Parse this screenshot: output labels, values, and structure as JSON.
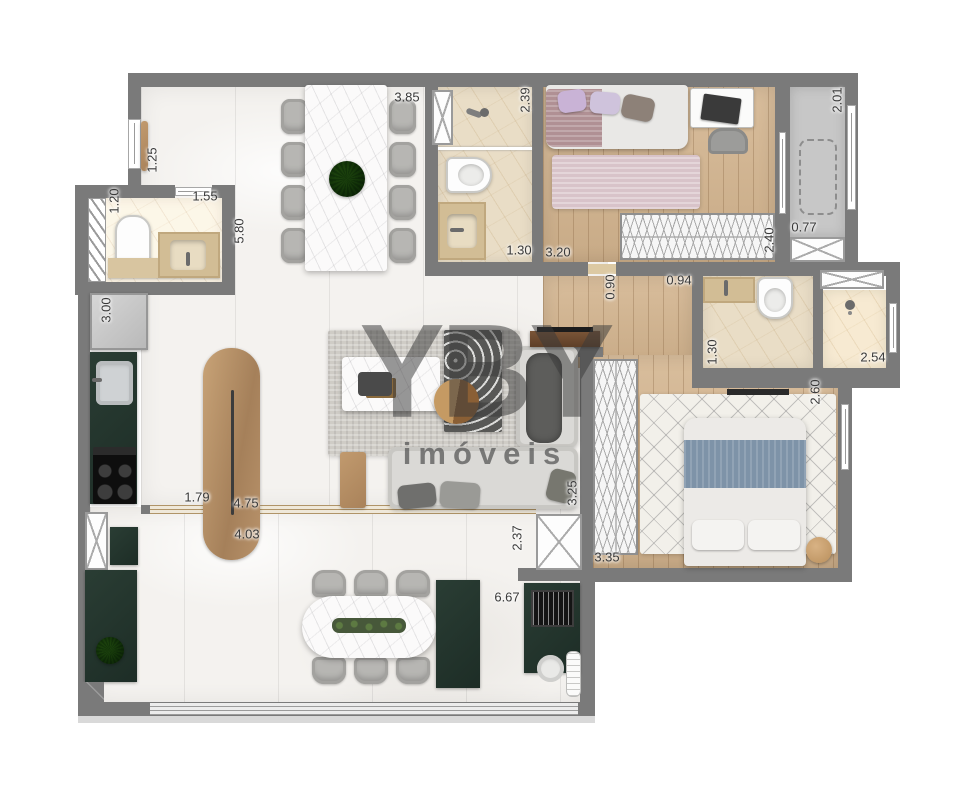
{
  "watermark": {
    "brand": "YBY",
    "subtitle": "imóveis"
  },
  "colors": {
    "wall": "#7a7a7a",
    "marble_floor": "#f4f2ef",
    "wood_floor": "#d3b48e",
    "bath_floor": "#e9ddc6",
    "counter_green": "#22332c",
    "gray_room": "#c7c7c7",
    "watermark_text": "#4a4a4a"
  },
  "dimensions": [
    {
      "label": "1.25",
      "x": 152,
      "y": 160,
      "rot": true
    },
    {
      "label": "1.20",
      "x": 114,
      "y": 201,
      "rot": true
    },
    {
      "label": "1.55",
      "x": 205,
      "y": 196,
      "rot": false
    },
    {
      "label": "5.80",
      "x": 239,
      "y": 231,
      "rot": true
    },
    {
      "label": "3.85",
      "x": 407,
      "y": 97,
      "rot": false
    },
    {
      "label": "2.39",
      "x": 525,
      "y": 100,
      "rot": true
    },
    {
      "label": "1.30",
      "x": 519,
      "y": 250,
      "rot": false
    },
    {
      "label": "3.20",
      "x": 558,
      "y": 252,
      "rot": false
    },
    {
      "label": "0.90",
      "x": 610,
      "y": 287,
      "rot": true
    },
    {
      "label": "0.94",
      "x": 679,
      "y": 280,
      "rot": false
    },
    {
      "label": "2.40",
      "x": 769,
      "y": 240,
      "rot": true
    },
    {
      "label": "0.77",
      "x": 804,
      "y": 227,
      "rot": false
    },
    {
      "label": "2.01",
      "x": 837,
      "y": 100,
      "rot": true
    },
    {
      "label": "1.30",
      "x": 712,
      "y": 352,
      "rot": true
    },
    {
      "label": "2.54",
      "x": 873,
      "y": 357,
      "rot": false
    },
    {
      "label": "2.60",
      "x": 815,
      "y": 392,
      "rot": true
    },
    {
      "label": "3.00",
      "x": 106,
      "y": 310,
      "rot": true
    },
    {
      "label": "1.79",
      "x": 197,
      "y": 497,
      "rot": false
    },
    {
      "label": "4.75",
      "x": 246,
      "y": 503,
      "rot": false
    },
    {
      "label": "4.03",
      "x": 247,
      "y": 534,
      "rot": false
    },
    {
      "label": "3.25",
      "x": 572,
      "y": 493,
      "rot": true
    },
    {
      "label": "2.37",
      "x": 517,
      "y": 538,
      "rot": true
    },
    {
      "label": "3.35",
      "x": 607,
      "y": 557,
      "rot": false
    },
    {
      "label": "6.67",
      "x": 507,
      "y": 597,
      "rot": false
    }
  ]
}
